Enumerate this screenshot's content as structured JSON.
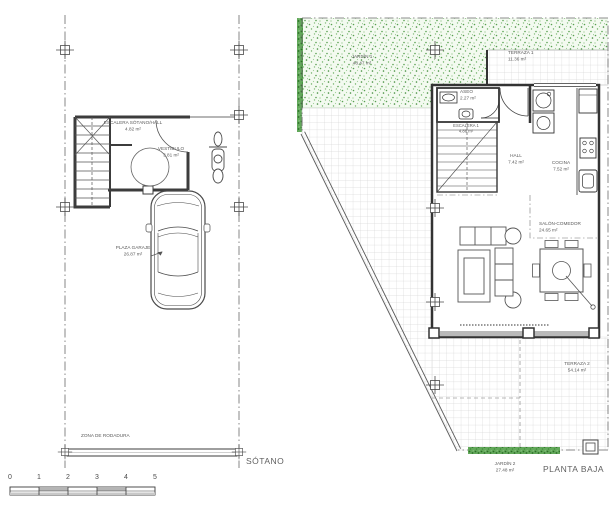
{
  "sotano": {
    "title": "SÓTANO",
    "rooms": {
      "escalera_hall": {
        "name": "ESCALERA SÓTANO/HALL",
        "area": "4.82 m²"
      },
      "vestibulo": {
        "name": "VESTÍBULO",
        "area": "3.81 m²"
      },
      "plaza_garaje": {
        "name": "PLAZA GARAJE",
        "area": "26.87 m²"
      },
      "zona_rodadura": {
        "name": "ZONA DE RODADURA"
      }
    }
  },
  "planta_baja": {
    "title": "PLANTA BAJA",
    "rooms": {
      "jardin1": {
        "name": "JARDÍN 1",
        "area": "48.47 m²"
      },
      "terraza1": {
        "name": "TERRAZA 1",
        "area": "11.36 m²"
      },
      "aseo": {
        "name": "ASEO",
        "area": "2.27 m²"
      },
      "escalera1": {
        "name": "ESCALERA 1",
        "area": "4.88 m²"
      },
      "hall": {
        "name": "HALL",
        "area": "7.42 m²"
      },
      "cocina": {
        "name": "COCINA",
        "area": "7.52 m²"
      },
      "salon_comedor": {
        "name": "SALÓN-COMEDOR",
        "area": "24.65 m²"
      },
      "terraza2": {
        "name": "TERRAZA 2",
        "area": "54.14 m²"
      },
      "jardin2": {
        "name": "JARDÍN 2",
        "area": "27.48 m²"
      }
    }
  },
  "scale_bar": {
    "ticks": [
      "0",
      "1",
      "2",
      "3",
      "4",
      "5"
    ]
  },
  "colors": {
    "line": "#3c3c3c",
    "garden_green": "#5fa457",
    "hedge_green": "#3f8c39",
    "tile_grid": "#d9d9d9"
  }
}
